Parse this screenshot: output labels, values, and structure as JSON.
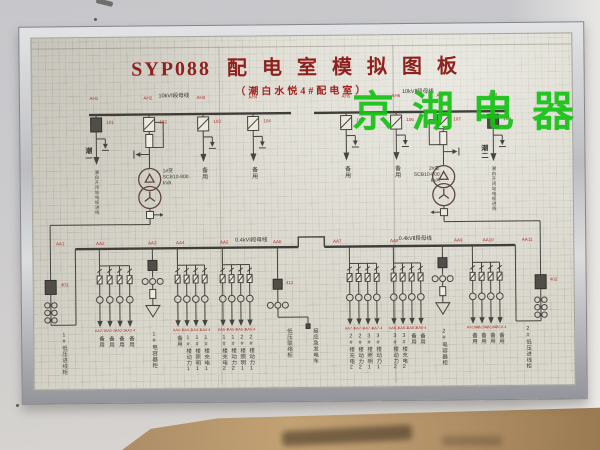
{
  "colors": {
    "title_red": "#8e211d",
    "code_red": "#b13028",
    "watermark_green": "#16c216",
    "line": "#45443e",
    "board": "#d9d7cc"
  },
  "watermark": {
    "text": "京湖电器"
  },
  "board": {
    "title_prefix": "SYP088",
    "title": "配电室模拟图板",
    "subtitle": "（潮白水悦4#配电室）",
    "hv": {
      "bus1_label": "10kVⅠ段母线",
      "bus2_label": "10kVⅡ段母线",
      "cabinet_codes": [
        "AH1",
        "AH2",
        "AH3",
        "AH4",
        "AH5",
        "AH6",
        "AH7",
        "AH8"
      ],
      "feeders": [
        {
          "code": "101",
          "name": "潮一",
          "desc": "潮白开闭站电缆进线"
        },
        {
          "code": "102",
          "name": "1#变",
          "spec": "SCB10-800",
          "unit": "kVA"
        },
        {
          "code": "103",
          "name": "备用"
        },
        {
          "code": "104",
          "name": "备用"
        },
        {
          "code": "105",
          "name": "备用"
        },
        {
          "code": "106",
          "name": "备用"
        },
        {
          "code": "107",
          "name": "2#变",
          "spec": "SCB10-800",
          "unit": "kVA"
        },
        {
          "code": "108",
          "name": "潮二",
          "desc": "潮白开闭站电缆进线"
        }
      ]
    },
    "lv": {
      "bus1_label": "0.4kVⅠ段母线",
      "bus2_label": "0.4kVⅡ段母线",
      "bus_codes": [
        "AA1",
        "AA2",
        "AA3",
        "AA4",
        "AA5",
        "AA6",
        "AA7",
        "AA8",
        "AA9",
        "AA10",
        "AA11"
      ],
      "incoming1": {
        "code": "401",
        "label": "1#低压进线柜"
      },
      "incoming2": {
        "code": "402",
        "label": "2#低压进线柜"
      },
      "tie": {
        "code": "412",
        "label": "低压联络柜",
        "gen_label": "接应急发电车"
      },
      "cap1": {
        "label": "1#电容器柜"
      },
      "cap2": {
        "label": "2#电容器柜"
      },
      "groups": [
        {
          "codes": [
            "AA2-1",
            "AA2-2",
            "AA2-3",
            "AA2-4"
          ],
          "labels": [
            "备用",
            "备用",
            "备用",
            "备用"
          ]
        },
        {
          "codes": [
            "AA4-1",
            "AA4-2",
            "AA4-3",
            "AA4-4"
          ],
          "labels": [
            "备用",
            "1#楼动力1",
            "1#楼照明1",
            "1#楼充电1"
          ]
        },
        {
          "codes": [
            "AA5-1",
            "AA5-2",
            "AA5-3",
            "AA5-4"
          ],
          "labels": [
            "1#楼充电2",
            "1#楼动力2",
            "2#楼照明1",
            "2#楼动力1"
          ]
        },
        {
          "codes": [
            "AA7-1",
            "AA7-2",
            "AA7-3",
            "AA7-4"
          ],
          "labels": [
            "2#楼充电2",
            "2#楼动力2",
            "3#楼照明1",
            "3#楼动力1"
          ]
        },
        {
          "codes": [
            "AA8-1",
            "AA8-2",
            "AA8-3",
            "AA8-4"
          ],
          "labels": [
            "3#楼动力2",
            "3#楼充电2",
            "备用",
            "备用"
          ]
        },
        {
          "codes": [
            "AA10-1",
            "AA10-2",
            "AA10-3",
            "AA10-4"
          ],
          "labels": [
            "备用",
            "备用",
            "备用",
            "备用"
          ]
        }
      ]
    }
  }
}
